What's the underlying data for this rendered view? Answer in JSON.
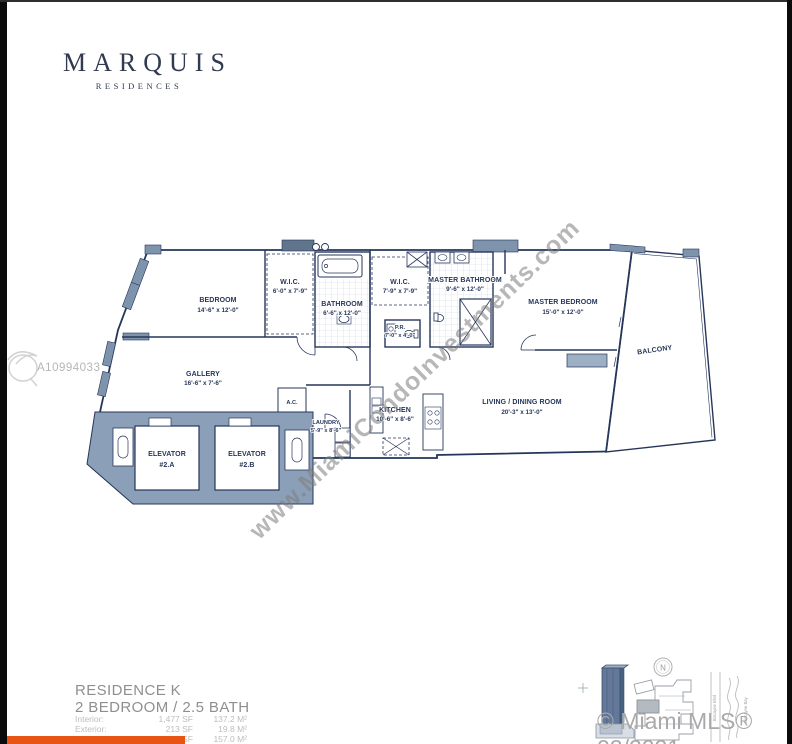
{
  "branding": {
    "logo_title": "MARQUIS",
    "logo_subtitle": "RESIDENCES"
  },
  "watermarks": {
    "mls_number": "A10994033",
    "diagonal": "www.MiamiCondoInvestments.com",
    "copyright": "© Miami MLS® 02/2021"
  },
  "residence": {
    "name": "RESIDENCE K",
    "config": "2 BEDROOM / 2.5 BATH",
    "areas": [
      {
        "label": "Interior:",
        "sf": "1,477 SF",
        "m2": "137.2 M²"
      },
      {
        "label": "Exterior:",
        "sf": "213 SF",
        "m2": "19.8 M²"
      },
      {
        "label": "Total:",
        "sf": "1,690 SF",
        "m2": "157.0 M²"
      }
    ]
  },
  "rooms": {
    "bedroom": {
      "name": "BEDROOM",
      "dims": "14'-6\" x 12'-0\""
    },
    "wic1": {
      "name": "W.I.C.",
      "dims": "6'-0\" x 7'-9\""
    },
    "bathroom": {
      "name": "BATHROOM",
      "dims": "6'-6\" x 12'-0\""
    },
    "wic2": {
      "name": "W.I.C.",
      "dims": "7'-9\" x 7'-9\""
    },
    "master_bathroom": {
      "name": "MASTER BATHROOM",
      "dims": "9'-6\" x 12'-0\""
    },
    "master_bedroom": {
      "name": "MASTER BEDROOM",
      "dims": "15'-0\" x 12'-0\""
    },
    "balcony": {
      "name": "BALCONY"
    },
    "gallery": {
      "name": "GALLERY",
      "dims": "16'-6\" x 7'-6\""
    },
    "pr": {
      "name": "P.R.",
      "dims": "7'-0\" x 4'-0\""
    },
    "ac": {
      "name": "A.C."
    },
    "laundry": {
      "name": "LAUNDRY",
      "dims": "5'-9\" x 8'-6\""
    },
    "kitchen": {
      "name": "KITCHEN",
      "dims": "10'-6\" x 8'-6\""
    },
    "living": {
      "name": "LIVING / DINING ROOM",
      "dims": "20'-3\" x 13'-0\""
    },
    "elevator_a": {
      "name": "ELEVATOR",
      "number": "#2.A"
    },
    "elevator_b": {
      "name": "ELEVATOR",
      "number": "#2.B"
    }
  },
  "keyplan": {
    "compass": "N",
    "street": "Biscayne Blvd",
    "bay": "Biscayne Bay"
  },
  "colors": {
    "accent_orange": "#E85414",
    "plan_navy": "#26365A",
    "wall_fill": "#93A7BD"
  }
}
